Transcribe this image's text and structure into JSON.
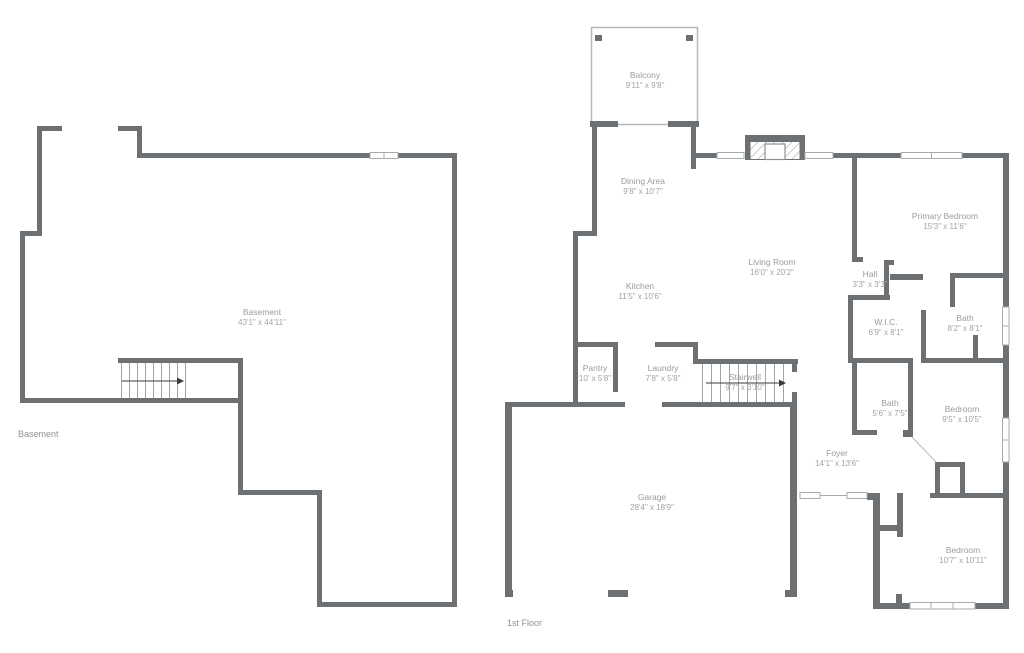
{
  "theme": {
    "wall_color": "#6c7072",
    "label_color": "#9b9b9b",
    "dims_color": "#a3a3a3",
    "window_line_color": "#a8abad",
    "stair_step_color": "#a3a6a8"
  },
  "floor_labels": {
    "basement": "Basement",
    "first_floor": "1st Floor"
  },
  "rooms": {
    "basement": {
      "name": "Basement",
      "dims": "43'1\" x 44'11\""
    },
    "balcony": {
      "name": "Balcony",
      "dims": "9'11\" x 9'8\""
    },
    "dining_area": {
      "name": "Dining Area",
      "dims": "9'8\" x 10'7\""
    },
    "living_room": {
      "name": "Living Room",
      "dims": "16'0\" x 20'2\""
    },
    "kitchen": {
      "name": "Kitchen",
      "dims": "11'5\" x 10'6\""
    },
    "primary_bedroom": {
      "name": "Primary Bedroom",
      "dims": "15'3\" x 11'6\""
    },
    "hall": {
      "name": "Hall",
      "dims": "3'3\" x 3'3\""
    },
    "wic": {
      "name": "W.I.C.",
      "dims": "6'9\" x 8'1\""
    },
    "bath_upper": {
      "name": "Bath",
      "dims": "8'2\" x 8'1\""
    },
    "pantry": {
      "name": "Pantry",
      "dims": "10' x 5'8\""
    },
    "laundry": {
      "name": "Laundry",
      "dims": "7'8\" x 5'8\""
    },
    "stairwell": {
      "name": "Stairwell",
      "dims": "9'7\" x 3'10\""
    },
    "bath_lower": {
      "name": "Bath",
      "dims": "5'6\" x 7'5\""
    },
    "bedroom_mid": {
      "name": "Bedroom",
      "dims": "9'5\" x 10'5\""
    },
    "foyer": {
      "name": "Foyer",
      "dims": "14'1\" x 13'6\""
    },
    "garage": {
      "name": "Garage",
      "dims": "28'4\" x 18'9\""
    },
    "bedroom_bottom": {
      "name": "Bedroom",
      "dims": "10'7\" x 10'11\""
    }
  }
}
